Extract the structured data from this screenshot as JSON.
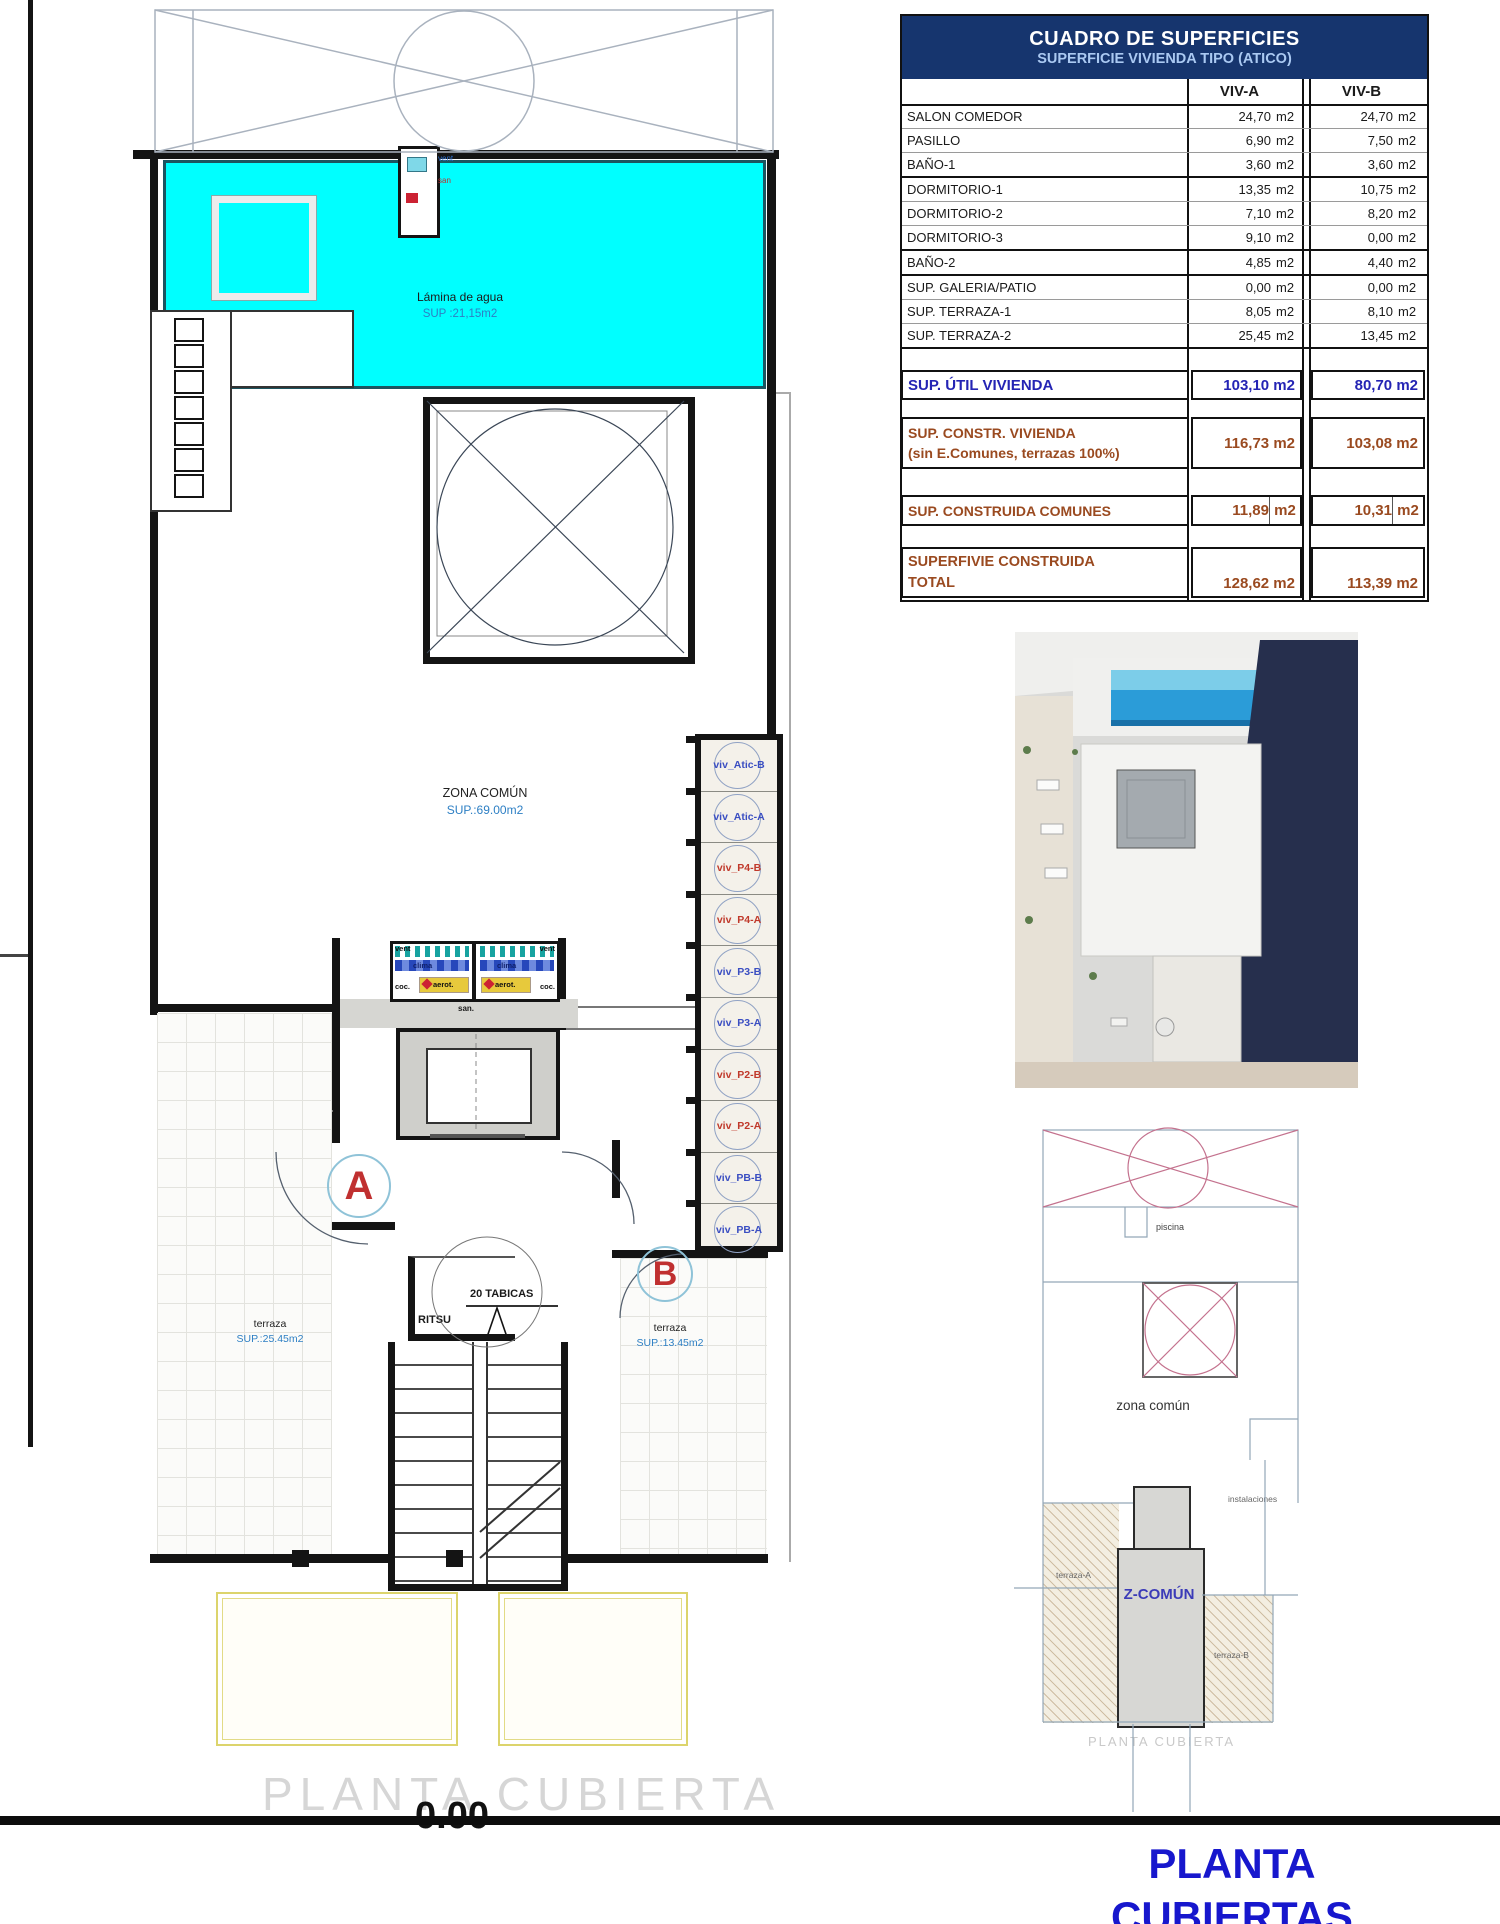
{
  "colors": {
    "header_bg": "#16356e",
    "header_text": "#ffffff",
    "subtitle_text": "#aac9f2",
    "util_blue": "#2424b4",
    "brown": "#9a4a20",
    "pool_cyan": "#00ffff",
    "label_blue": "#2d7fc4",
    "marker_red": "#c03030",
    "stack_blue": "#3a4ec2",
    "stack_red": "#c0392b",
    "title_blue": "#1717cd",
    "balcony_yellow": "#dcd46c"
  },
  "table": {
    "title": "CUADRO DE SUPERFICIES",
    "subtitle": "SUPERFICIE VIVIENDA TIPO  (ATICO)",
    "columns": [
      "VIV-A",
      "VIV-B"
    ],
    "unit": "m2",
    "rows": [
      {
        "label": "SALON COMEDOR",
        "a": "24,70",
        "b": "24,70"
      },
      {
        "label": "PASILLO",
        "a": "6,90",
        "b": "7,50"
      },
      {
        "label": "BAÑO-1",
        "a": "3,60",
        "b": "3,60"
      },
      {
        "label": "DORMITORIO-1",
        "a": "13,35",
        "b": "10,75"
      },
      {
        "label": "DORMITORIO-2",
        "a": "7,10",
        "b": "8,20"
      },
      {
        "label": "DORMITORIO-3",
        "a": "9,10",
        "b": "0,00"
      },
      {
        "label": "BAÑO-2",
        "a": "4,85",
        "b": "4,40"
      },
      {
        "label": "SUP. GALERIA/PATIO",
        "a": "0,00",
        "b": "0,00"
      },
      {
        "label": "SUP. TERRAZA-1",
        "a": "8,05",
        "b": "8,10"
      },
      {
        "label": "SUP. TERRAZA-2",
        "a": "25,45",
        "b": "13,45"
      }
    ],
    "util": {
      "label": "SUP. ÚTIL VIVIENDA",
      "a": "103,10 m2",
      "b": "80,70 m2"
    },
    "constr": {
      "label1": "SUP. CONSTR. VIVIENDA",
      "label2": "(sin E.Comunes, terrazas 100%)",
      "a": "116,73 m2",
      "b": "103,08 m2"
    },
    "comunes": {
      "label": "SUP. CONSTRUIDA COMUNES",
      "a": "11,89",
      "a_unit": "m2",
      "b": "10,31",
      "b_unit": "m2"
    },
    "total": {
      "label1": "SUPERFIVIE CONSTRUIDA",
      "label2": "TOTAL",
      "a": "128,62 m2",
      "b": "113,39 m2"
    }
  },
  "plan": {
    "pool_label": "Lámina de agua",
    "pool_sup": "SUP :21,15m2",
    "zona_label": "ZONA COMÚN",
    "zona_sup": "SUP.:69.00m2",
    "terraza_a_label": "terraza",
    "terraza_a_sup": "SUP.:25.45m2",
    "terraza_b_label": "terraza",
    "terraza_b_sup": "SUP.:13.45m2",
    "marker_a": "A",
    "marker_b": "B",
    "ritsu": "RITSU",
    "tabicas": "20 TABICAS",
    "vent_top": "vent",
    "san_top": "san",
    "services": {
      "vent_l": "vent",
      "vent_r": "vent",
      "clima_l": "clima",
      "clima_r": "clima",
      "coc_l": "coc.",
      "coc_r": "coc.",
      "aerot_l": "aerot.",
      "aerot_r": "aerot.",
      "san": "san."
    },
    "stack": [
      {
        "label": "viv_Atic-B",
        "color": "blue"
      },
      {
        "label": "viv_Atic-A",
        "color": "blue"
      },
      {
        "label": "viv_P4-B",
        "color": "red"
      },
      {
        "label": "viv_P4-A",
        "color": "red"
      },
      {
        "label": "viv_P3-B",
        "color": "blue"
      },
      {
        "label": "viv_P3-A",
        "color": "blue"
      },
      {
        "label": "viv_P2-B",
        "color": "red"
      },
      {
        "label": "viv_P2-A",
        "color": "red"
      },
      {
        "label": "viv_PB-B",
        "color": "blue"
      },
      {
        "label": "viv_PB-A",
        "color": "blue"
      }
    ],
    "caption": "PLANTA CUBIERTA",
    "elevation": "0.00"
  },
  "small_plan": {
    "piscina": "piscina",
    "zona": "zona común",
    "instalaciones": "instalaciones",
    "terraza_a": "terraza-A",
    "z_comun": "Z-COMÚN",
    "terraza_b": "terraza-B",
    "caption": "PLANTA CUBIERTA"
  },
  "footer": {
    "title": "PLANTA CUBIERTAS"
  }
}
